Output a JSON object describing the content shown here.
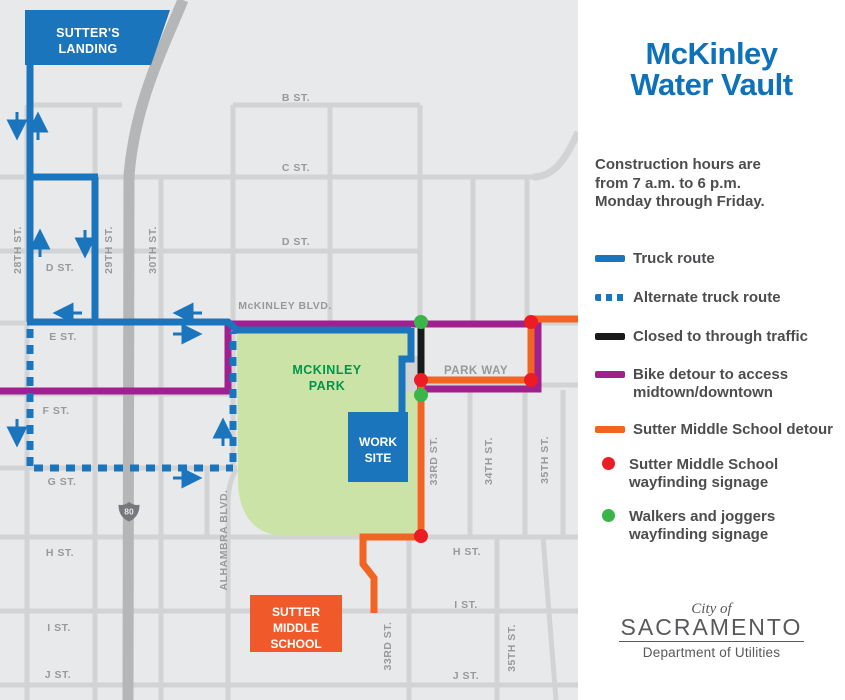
{
  "panel": {
    "title": {
      "line1": "McKinley",
      "line2": "Water Vault"
    },
    "hours": {
      "line1": "Construction hours are",
      "line2": "from 7 a.m. to 6 p.m.",
      "line3": "Monday through Friday."
    },
    "legend": {
      "truck": "Truck route",
      "alternate": "Alternate truck route",
      "closed": "Closed to through traffic",
      "bike1": "Bike detour to access",
      "bike2": "midtown/downtown",
      "school_detour": "Sutter Middle School detour",
      "red1": "Sutter Middle School",
      "red2": "wayfinding signage",
      "green1": "Walkers and joggers",
      "green2": "wayfinding signage"
    },
    "logo": {
      "city_of": "City of",
      "city": "SACRAMENTO",
      "dept": "Department of Utilities"
    }
  },
  "map": {
    "shield": "80",
    "park": {
      "line1": "MCKINLEY",
      "line2": "PARK"
    },
    "boxes": {
      "sutters1": "SUTTER'S",
      "sutters2": "LANDING",
      "work1": "WORK",
      "work2": "SITE",
      "school1": "SUTTER",
      "school2": "MIDDLE",
      "school3": "SCHOOL"
    },
    "labels": {
      "b": "B ST.",
      "c": "C ST.",
      "d_e": "D ST.",
      "d_w": "D ST.",
      "e": "E ST.",
      "f": "F ST.",
      "g": "G ST.",
      "h_w": "H ST.",
      "i_w": "I ST.",
      "j_w": "J ST.",
      "h_e": "H ST.",
      "i_e": "I ST.",
      "j_e": "J ST.",
      "mckinley": "McKINLEY BLVD.",
      "parkway": "PARK WAY",
      "s28": "28TH ST.",
      "s29": "29TH ST.",
      "s30": "30TH ST.",
      "alhambra": "ALHAMBRA BLVD.",
      "s33n": "33RD ST.",
      "s34": "34TH ST.",
      "s35n": "35TH ST.",
      "s33s": "33RD ST.",
      "s35s": "35TH ST."
    }
  },
  "colors": {
    "truck_blue": "#1B75BC",
    "title_blue": "#0D72BA",
    "bike_purple": "#A0208F",
    "detour_orange": "#F26422",
    "closed_black": "#1A1A1A",
    "signage_red": "#EB1C23",
    "signage_green": "#3BB54A",
    "park_green": "#CBE3A6",
    "park_text_green": "#009648",
    "school_box_orange": "#F05A2B",
    "map_background": "#E8E9EA",
    "street_gray": "#D2D3D5",
    "freeway_gray": "#B4B6B8",
    "street_label_gray": "#97999C",
    "panel_text_gray": "#4D4D4F"
  }
}
